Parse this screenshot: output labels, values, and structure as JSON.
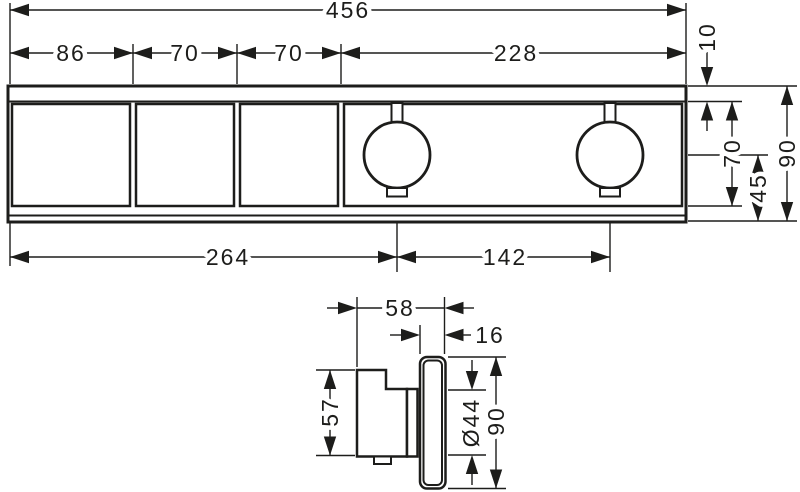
{
  "colors": {
    "ink": "#1d1d1b",
    "background": "#ffffff"
  },
  "front_view": {
    "total_width": "456",
    "segment_1": "86",
    "segment_2": "70",
    "segment_3": "70",
    "segment_4": "228",
    "top_edge_offset": "10",
    "inner_face_height": "70",
    "total_height": "90",
    "handle_center_to_bottom": "45",
    "left_edge_to_handle_center": "264",
    "handle_center_spacing": "142"
  },
  "side_view": {
    "total_depth": "58",
    "escutcheon_protrusion": "16",
    "body_height": "57",
    "handle_diameter": "Ø44",
    "escutcheon_height": "90"
  }
}
